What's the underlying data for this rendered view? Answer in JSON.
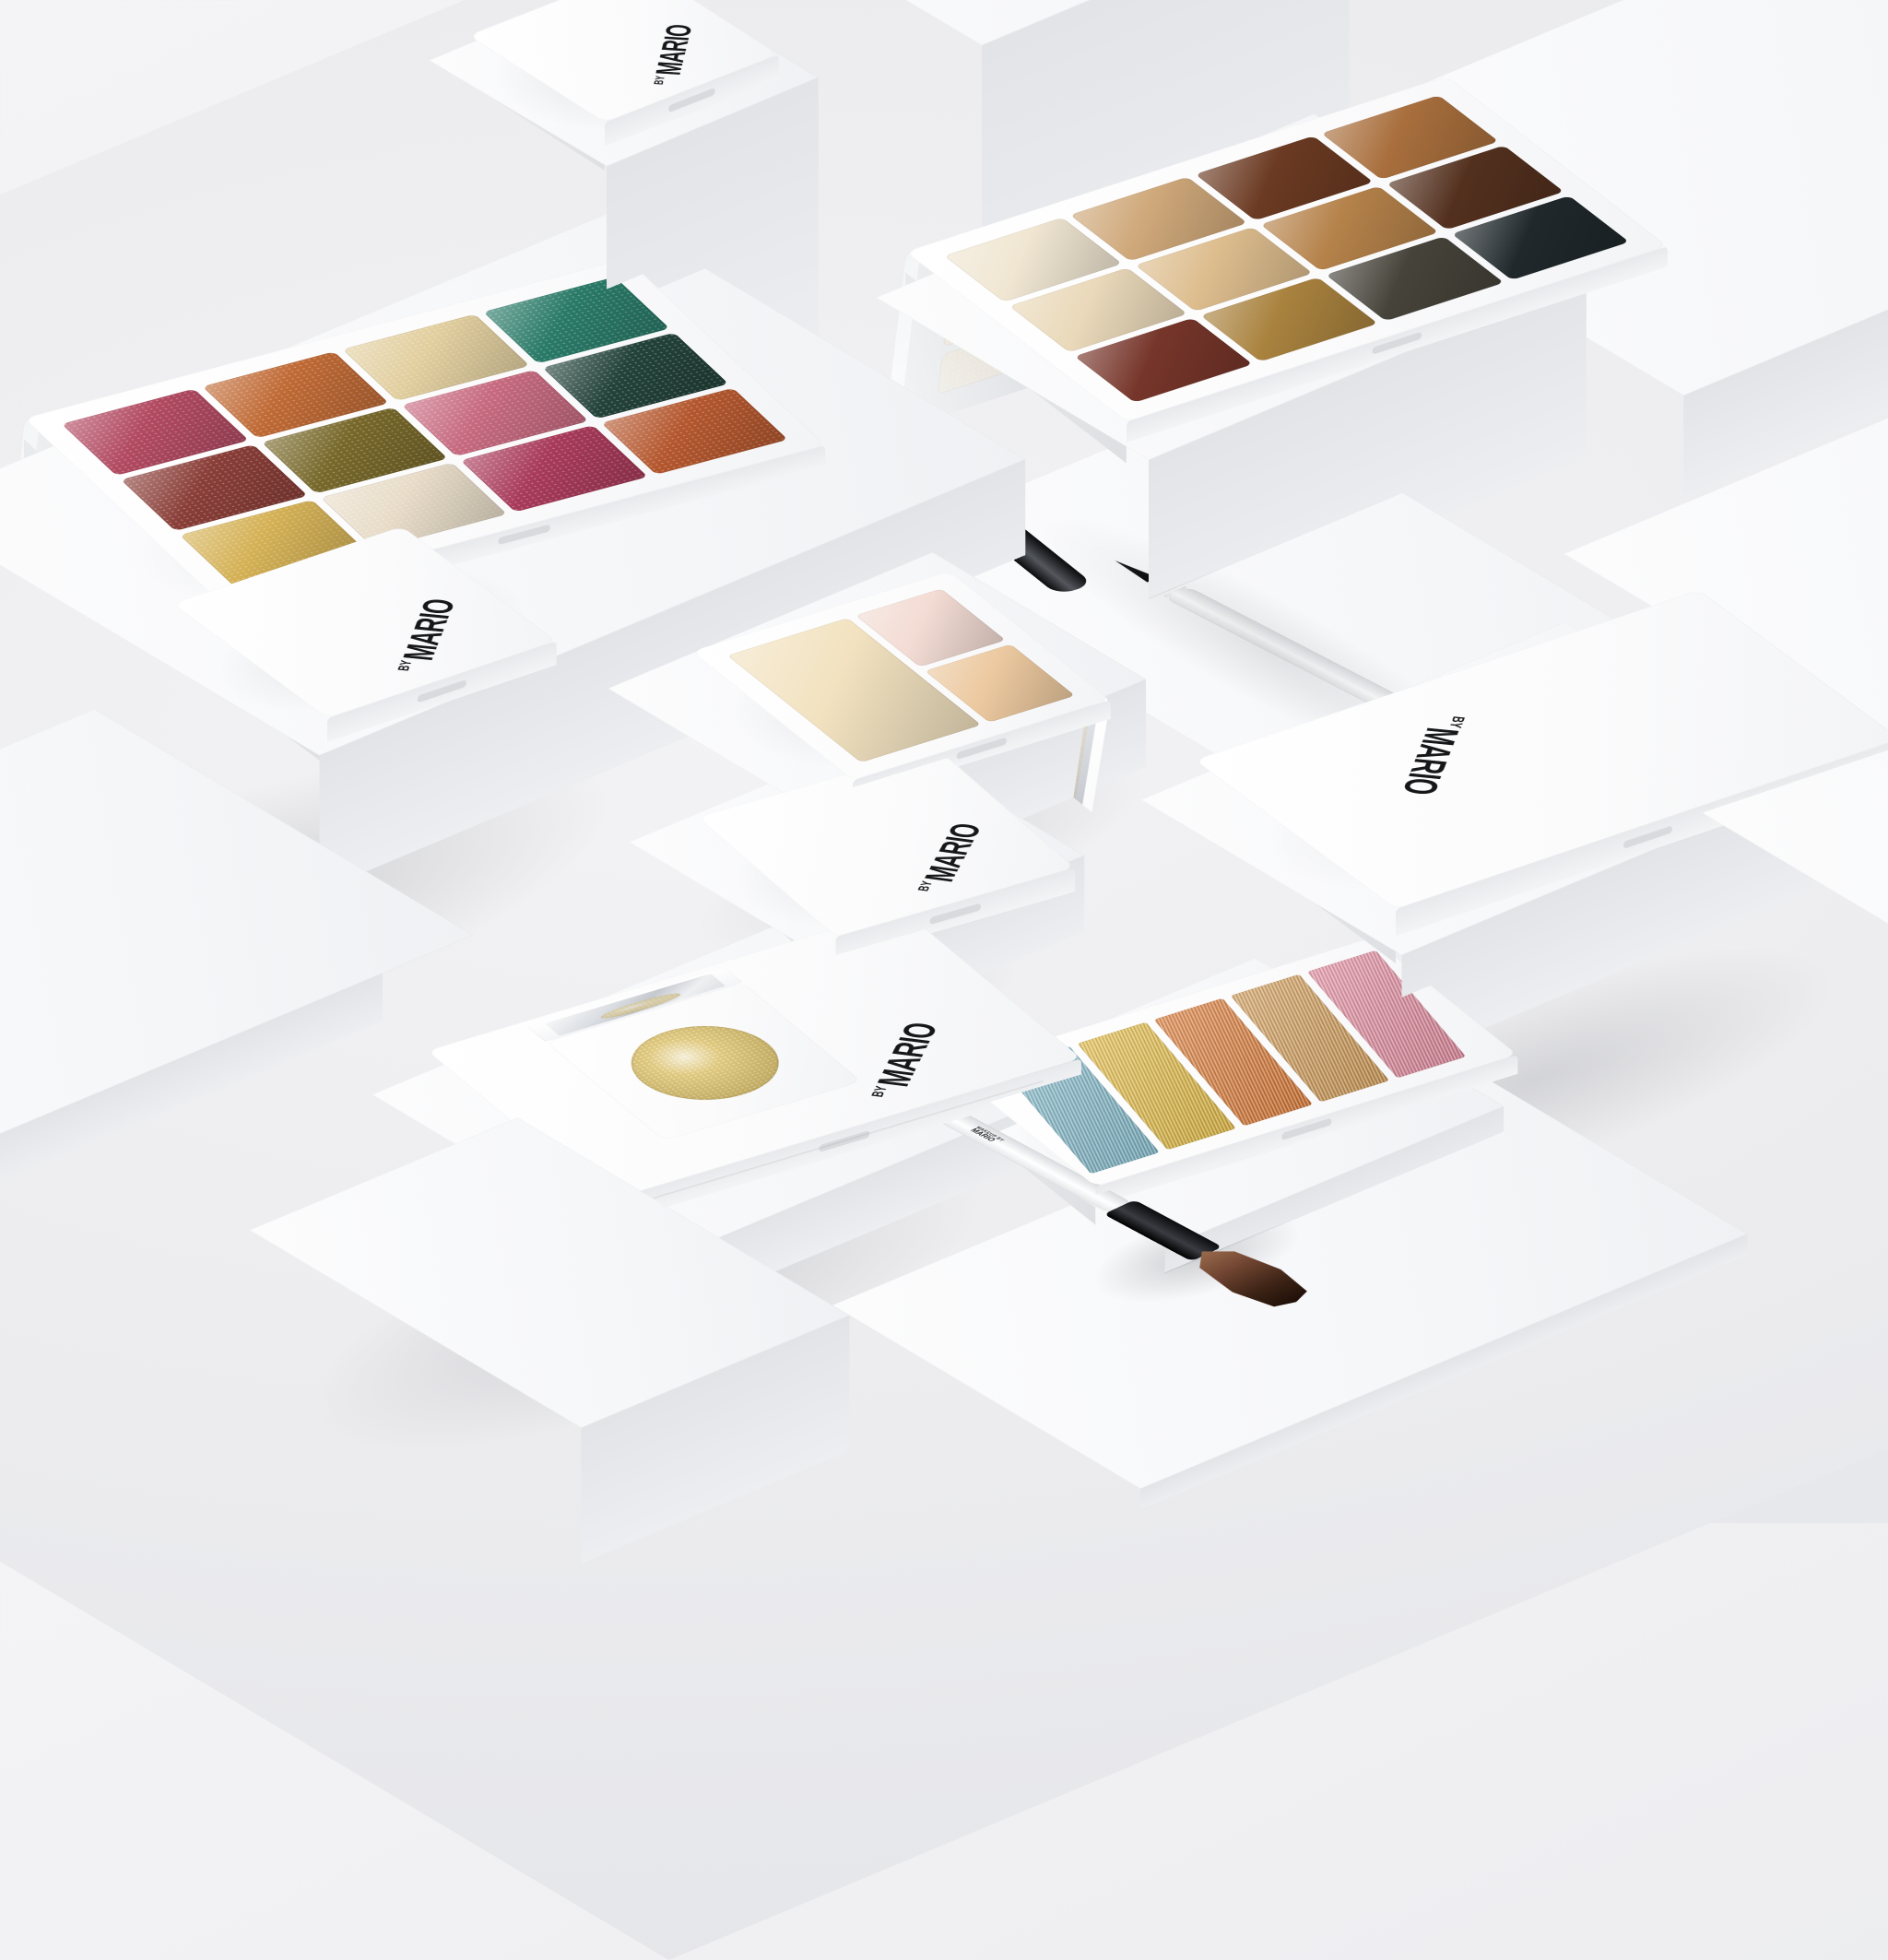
{
  "brand": {
    "by": "BY",
    "name": "MARIO",
    "maker_line1": "MAKEUP BY",
    "maker_line2": "MARIO"
  },
  "products": {
    "glitter_palette": {
      "pans": [
        "#b24a62",
        "#c06a35",
        "#e2cf9f",
        "#2a7a68",
        "#8a3e38",
        "#77682a",
        "#c76a80",
        "#23423a",
        "#d4b155",
        "#e8dcc8",
        "#a83a5a",
        "#b4572e"
      ]
    },
    "neutral_palette": {
      "pans": [
        "#f0e6d2",
        "#cfa87a",
        "#6b3a22",
        "#a96f3d",
        "#ead9ba",
        "#ddbd8e",
        "#b5824a",
        "#53301e",
        "#76352a",
        "#a9823e",
        "#46433a",
        "#20282b"
      ]
    },
    "concealer_palette": {
      "pans": [
        "#f2e2c0",
        "#f3dcd4",
        "#ecc9a0"
      ]
    },
    "metallic_palette": {
      "pans": [
        "#7eb7c8",
        "#e2b93e",
        "#da7630",
        "#cf9851",
        "#e1879b"
      ]
    },
    "gold_topper": {
      "pan": "#d9bd62"
    }
  },
  "materials": {
    "backdrop": "#f1f1f3",
    "block_top": "#fafafb",
    "block_side_light": "#e7e8eb",
    "block_side_dark": "#d4d5d9",
    "mirror_light": "#f5f6f8",
    "mirror_dark": "#c6c9cf",
    "case_white": "#fdfdfe",
    "logo_ink": "#161719",
    "bristle_brown": "#6e4330",
    "gloss_black": "#101113",
    "gold": "#d9bd62"
  }
}
